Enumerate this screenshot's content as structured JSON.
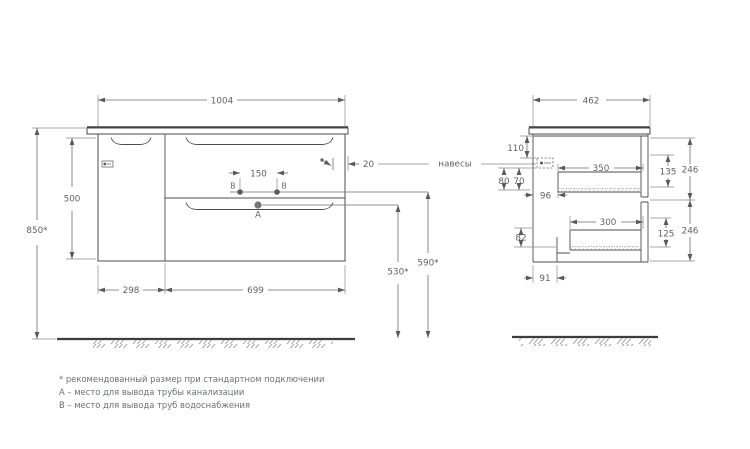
{
  "drawing": {
    "front_view": {
      "dim_width": "1004",
      "dim_height": "500",
      "dim_total_height": "850*",
      "dim_door_width": "298",
      "dim_drawer_width": "699",
      "dim_b_spacing": "150",
      "dim_hanger_offset": "20",
      "dim_drain_height": "530*",
      "dim_supply_height": "590*",
      "point_a": "A",
      "point_b_left": "B",
      "point_b_right": "B"
    },
    "side_view": {
      "dim_depth": "462",
      "dim_hanger_top": "110",
      "dim_hanger_h": "80",
      "dim_hanger_h2": "70",
      "dim_hanger_depth": "96",
      "dim_drawer1_depth": "350",
      "dim_drawer1_inner_h": "135",
      "dim_drawer1_front_h": "246",
      "dim_drawer2_depth": "300",
      "dim_drawer2_inner_h": "125",
      "dim_drawer2_front_h": "246",
      "dim_bottom_h": "82",
      "dim_back_gap": "91"
    },
    "labels": {
      "hangers": "навесы"
    },
    "notes": [
      "* рекомендованный размер при стандартном подключении",
      "А – место для вывода трубы канализации",
      "В – место для вывода труб водоснабжения"
    ],
    "colors": {
      "line": "#4d4d4d",
      "dim_text": "#5f6368",
      "floor": "#3c3c3c",
      "hatch": "#9a9a9a",
      "background": "#ffffff"
    }
  }
}
